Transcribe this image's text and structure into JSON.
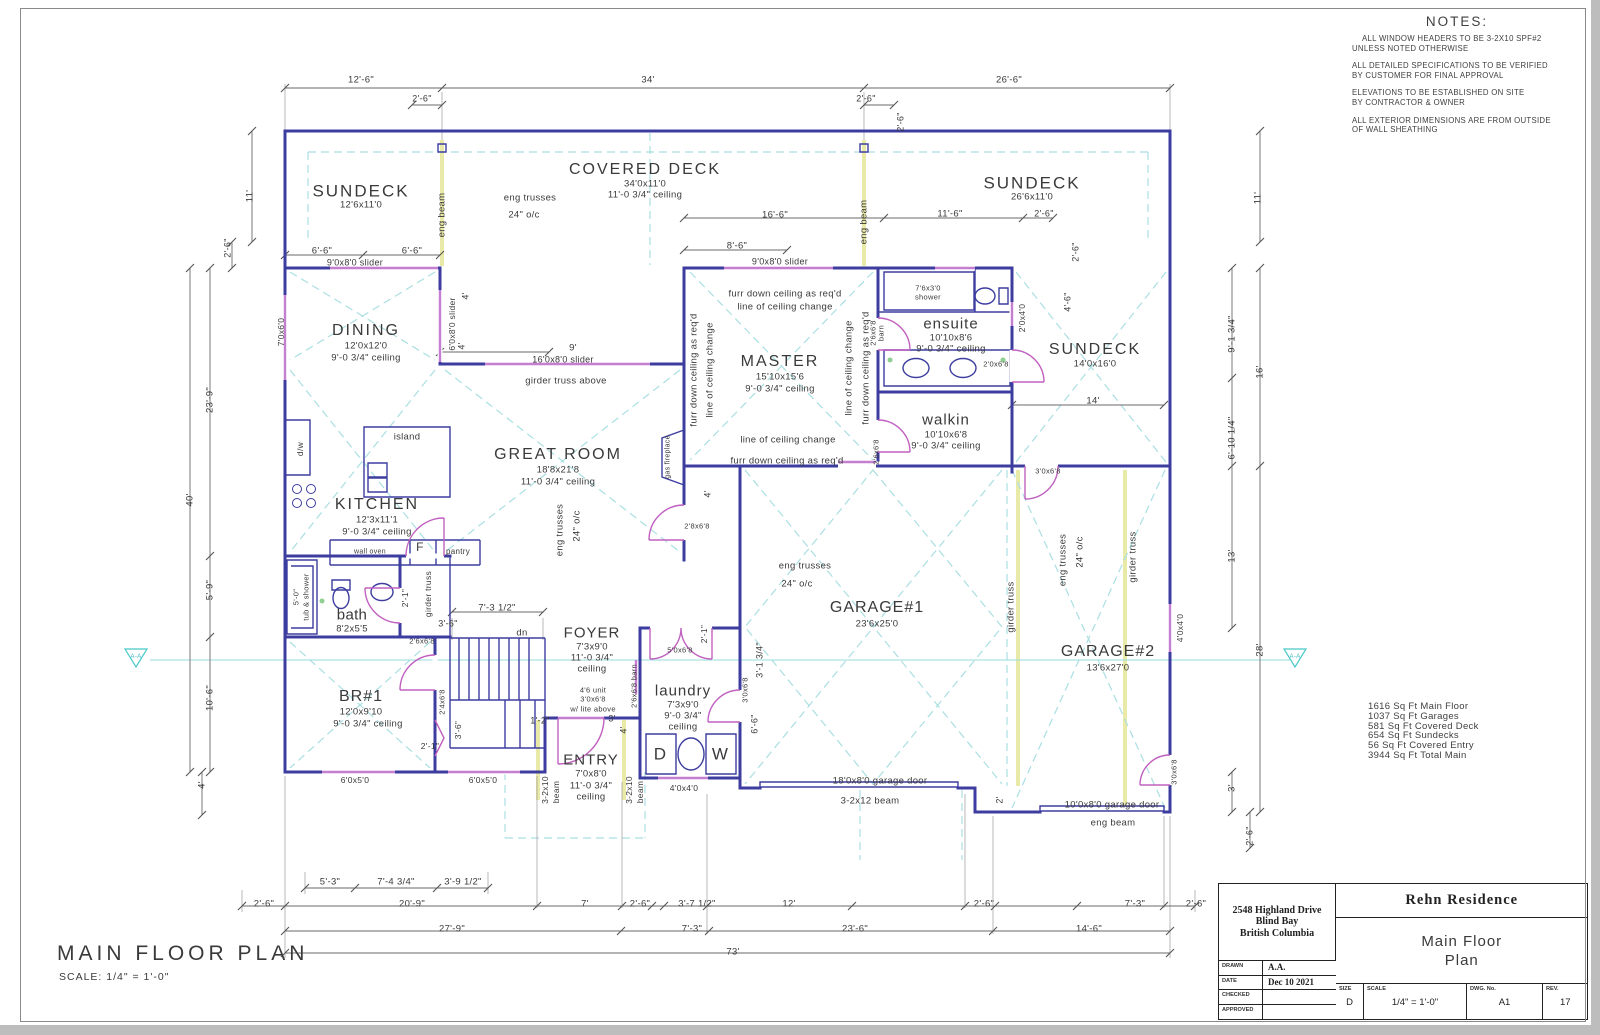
{
  "sheet": {
    "plan_title": "MAIN FLOOR PLAN",
    "plan_scale": "SCALE: 1/4\" = 1'-0\""
  },
  "notes": {
    "title": "NOTES:",
    "items": [
      "ALL WINDOW HEADERS TO BE 3-2X10 SPF#2\nUNLESS NOTED OTHERWISE",
      "ALL DETAILED SPECIFICATIONS TO BE VERIFIED\nBY CUSTOMER FOR FINAL APPROVAL",
      "ELEVATIONS TO BE ESTABLISHED ON SITE\nBY CONTRACTOR & OWNER",
      "ALL EXTERIOR DIMENSIONS ARE FROM OUTSIDE\nOF WALL SHEATHING"
    ]
  },
  "area_summary": [
    "1616 Sq Ft Main Floor",
    "1037 Sq Ft Garages",
    "581 Sq Ft Covered Deck",
    "654 Sq Ft Sundecks",
    "56 Sq Ft Covered Entry",
    "3944 Sq Ft Total Main"
  ],
  "title_block": {
    "address": [
      "2548 Highland Drive",
      "Blind Bay",
      "British Columbia"
    ],
    "project": "Rehn Residence",
    "drawing_title": [
      "Main Floor",
      "Plan"
    ],
    "fields": [
      {
        "label": "DRAWN",
        "value": "A.A."
      },
      {
        "label": "DATE",
        "value": "Dec 10 2021"
      },
      {
        "label": "CHECKED",
        "value": ""
      },
      {
        "label": "APPROVED",
        "value": ""
      }
    ],
    "size_label": "SIZE",
    "size": "D",
    "scale_label": "SCALE",
    "scale": "1/4\" = 1'-0\"",
    "dwg_label": "DWG. No.",
    "dwg": "A1",
    "rev_label": "REV.",
    "rev": "17"
  },
  "colors": {
    "wall": "#3d3da0",
    "window": "#c47fd0",
    "door_swing": "#c060c0",
    "truss_dashed": "#aadfe2",
    "beam_highlight": "#e9e9a8",
    "dimension": "#6a6a6a",
    "text": "#3a3a3a"
  },
  "plan": {
    "labels": [
      {
        "t": "12'-6\"",
        "x": 361,
        "y": 80
      },
      {
        "t": "2'-6\"",
        "x": 422,
        "y": 99,
        "fs": 9
      },
      {
        "t": "34'",
        "x": 648,
        "y": 80
      },
      {
        "t": "2'-6\"",
        "x": 866,
        "y": 99,
        "fs": 9
      },
      {
        "t": "26'-6\"",
        "x": 1009,
        "y": 80
      },
      {
        "t": "2'-6\"",
        "x": 901,
        "y": 122,
        "r": -90,
        "fs": 9
      },
      {
        "t": "SUNDECK",
        "x": 361,
        "y": 191,
        "fs": 17,
        "ls": 2
      },
      {
        "t": "12'6x11'0",
        "x": 361,
        "y": 205
      },
      {
        "t": "COVERED DECK",
        "x": 645,
        "y": 170,
        "fs": 16,
        "ls": 2
      },
      {
        "t": "34'0x11'0",
        "x": 645,
        "y": 184
      },
      {
        "t": "11'-0 3/4\" ceiling",
        "x": 645,
        "y": 195
      },
      {
        "t": "eng trusses",
        "x": 530,
        "y": 198
      },
      {
        "t": "24\" o/c",
        "x": 524,
        "y": 215
      },
      {
        "t": "eng beam",
        "x": 442,
        "y": 215,
        "r": -90,
        "fs": 9.5
      },
      {
        "t": "eng beam",
        "x": 864,
        "y": 222,
        "r": -90,
        "fs": 9.5
      },
      {
        "t": "SUNDECK",
        "x": 1032,
        "y": 183,
        "fs": 17,
        "ls": 2
      },
      {
        "t": "26'6x11'0",
        "x": 1032,
        "y": 197
      },
      {
        "t": "11'",
        "x": 250,
        "y": 196,
        "r": -90
      },
      {
        "t": "11'",
        "x": 1258,
        "y": 198,
        "r": -90
      },
      {
        "t": "16'-6\"",
        "x": 775,
        "y": 215
      },
      {
        "t": "11'-6\"",
        "x": 950,
        "y": 214
      },
      {
        "t": "2'-6\"",
        "x": 1044,
        "y": 214,
        "fs": 9
      },
      {
        "t": "8'-6\"",
        "x": 737,
        "y": 246
      },
      {
        "t": "2'-6\"",
        "x": 1076,
        "y": 252,
        "r": -90,
        "fs": 9
      },
      {
        "t": "4'-6\"",
        "x": 1068,
        "y": 302,
        "r": -90,
        "fs": 9
      },
      {
        "t": "6'-6\"",
        "x": 322,
        "y": 251,
        "fs": 9.5
      },
      {
        "t": "6'-6\"",
        "x": 412,
        "y": 251,
        "fs": 9.5
      },
      {
        "t": "9'0x8'0 slider",
        "x": 355,
        "y": 263,
        "fs": 9
      },
      {
        "t": "9'0x8'0 slider",
        "x": 780,
        "y": 262,
        "fs": 9
      },
      {
        "t": "2'-6\"",
        "x": 228,
        "y": 248,
        "r": -90,
        "fs": 9
      },
      {
        "t": "DINING",
        "x": 366,
        "y": 331,
        "fs": 16,
        "ls": 2
      },
      {
        "t": "12'0x12'0",
        "x": 366,
        "y": 346
      },
      {
        "t": "9'-0 3/4\" ceiling",
        "x": 366,
        "y": 358
      },
      {
        "t": "7'0x6'0",
        "x": 281,
        "y": 332,
        "r": -90,
        "fs": 8.5
      },
      {
        "t": "6'0x8'0 slider",
        "x": 452,
        "y": 324,
        "r": -90,
        "fs": 8.5
      },
      {
        "t": "4'",
        "x": 466,
        "y": 296,
        "r": -90,
        "fs": 9
      },
      {
        "t": "4'",
        "x": 462,
        "y": 346,
        "r": -90,
        "fs": 9
      },
      {
        "t": "9'",
        "x": 573,
        "y": 348,
        "fs": 9.5
      },
      {
        "t": "16'0x8'0 slider",
        "x": 563,
        "y": 360,
        "fs": 9
      },
      {
        "t": "girder truss above",
        "x": 566,
        "y": 381,
        "fs": 9.5
      },
      {
        "t": "island",
        "x": 407,
        "y": 437,
        "fs": 9.5
      },
      {
        "t": "KITCHEN",
        "x": 377,
        "y": 505,
        "fs": 16,
        "ls": 2
      },
      {
        "t": "12'3x11'1",
        "x": 377,
        "y": 520
      },
      {
        "t": "9'-0 3/4\" ceiling",
        "x": 377,
        "y": 532
      },
      {
        "t": "d/w",
        "x": 300,
        "y": 449,
        "r": -90,
        "fs": 8.5
      },
      {
        "t": "wall oven",
        "x": 370,
        "y": 552,
        "fs": 7
      },
      {
        "t": "pantry",
        "x": 458,
        "y": 552,
        "fs": 8
      },
      {
        "t": "F",
        "x": 420,
        "y": 547,
        "fs": 12
      },
      {
        "t": "girder truss",
        "x": 428,
        "y": 594,
        "r": -90,
        "fs": 8.5
      },
      {
        "t": "GREAT ROOM",
        "x": 558,
        "y": 455,
        "fs": 16,
        "ls": 2
      },
      {
        "t": "18'8x21'8",
        "x": 558,
        "y": 470
      },
      {
        "t": "11'-0 3/4\" ceiling",
        "x": 558,
        "y": 482
      },
      {
        "t": "eng trusses",
        "x": 560,
        "y": 530,
        "r": -90
      },
      {
        "t": "24\" o/c",
        "x": 577,
        "y": 526,
        "r": -90
      },
      {
        "t": "gas fireplace",
        "x": 668,
        "y": 457,
        "r": -90,
        "fs": 7
      },
      {
        "t": "furr down ceiling as req'd",
        "x": 785,
        "y": 294,
        "fs": 9.5
      },
      {
        "t": "line of ceiling change",
        "x": 785,
        "y": 307,
        "fs": 9.5
      },
      {
        "t": "MASTER",
        "x": 780,
        "y": 362,
        "fs": 16,
        "ls": 2
      },
      {
        "t": "15'10x15'6",
        "x": 780,
        "y": 377
      },
      {
        "t": "9'-0 3/4\" ceiling",
        "x": 780,
        "y": 389
      },
      {
        "t": "line of ceiling change",
        "x": 788,
        "y": 440,
        "fs": 9.5
      },
      {
        "t": "furr down ceiling as req'd",
        "x": 787,
        "y": 461,
        "fs": 9.5
      },
      {
        "t": "furr down ceiling as req'd",
        "x": 694,
        "y": 370,
        "r": -90,
        "fs": 9.5
      },
      {
        "t": "line of ceiling change",
        "x": 710,
        "y": 370,
        "r": -90,
        "fs": 9.5
      },
      {
        "t": "line of ceiling change",
        "x": 849,
        "y": 368,
        "r": -90,
        "fs": 9.5
      },
      {
        "t": "furr down ceiling as req'd",
        "x": 866,
        "y": 368,
        "r": -90,
        "fs": 9.5
      },
      {
        "t": "2'6x6'8",
        "x": 873,
        "y": 333,
        "r": -90,
        "fs": 7.5
      },
      {
        "t": "barn",
        "x": 881,
        "y": 333,
        "r": -90,
        "fs": 7.5
      },
      {
        "t": "2'6x6'8",
        "x": 876,
        "y": 452,
        "r": -90,
        "fs": 7.5
      },
      {
        "t": "2'8x6'8",
        "x": 697,
        "y": 526,
        "fs": 7.5
      },
      {
        "t": "4'",
        "x": 708,
        "y": 494,
        "r": -90,
        "fs": 9
      },
      {
        "t": "7'6x3'0",
        "x": 928,
        "y": 288,
        "fs": 7.5
      },
      {
        "t": "shower",
        "x": 928,
        "y": 297,
        "fs": 7.5
      },
      {
        "t": "ensuite",
        "x": 951,
        "y": 324,
        "fs": 15,
        "ls": 1
      },
      {
        "t": "10'10x8'6",
        "x": 951,
        "y": 338
      },
      {
        "t": "9'-0 3/4\" ceiling",
        "x": 951,
        "y": 349
      },
      {
        "t": "2'0x4'0",
        "x": 1022,
        "y": 318,
        "r": -90,
        "fs": 8.5
      },
      {
        "t": "2'0x6'8",
        "x": 996,
        "y": 364,
        "fs": 7.5
      },
      {
        "t": "walkin",
        "x": 946,
        "y": 420,
        "fs": 15,
        "ls": 1
      },
      {
        "t": "10'10x6'8",
        "x": 946,
        "y": 435
      },
      {
        "t": "9'-0 3/4\" ceiling",
        "x": 946,
        "y": 446
      },
      {
        "t": "SUNDECK",
        "x": 1095,
        "y": 350,
        "fs": 16,
        "ls": 2
      },
      {
        "t": "14'0x16'0",
        "x": 1095,
        "y": 364
      },
      {
        "t": "14'",
        "x": 1093,
        "y": 401
      },
      {
        "t": "3'0x6'8",
        "x": 1048,
        "y": 471,
        "fs": 7.5
      },
      {
        "t": "9'-1 3/4\"",
        "x": 1232,
        "y": 334,
        "r": -90
      },
      {
        "t": "16'",
        "x": 1260,
        "y": 372,
        "r": -90
      },
      {
        "t": "6'-10 1/4\"",
        "x": 1232,
        "y": 438,
        "r": -90
      },
      {
        "t": "13'",
        "x": 1232,
        "y": 556,
        "r": -90
      },
      {
        "t": "28'",
        "x": 1260,
        "y": 650,
        "r": -90
      },
      {
        "t": "4'0x4'0",
        "x": 1180,
        "y": 628,
        "r": -90,
        "fs": 8.5
      },
      {
        "t": "3'",
        "x": 1232,
        "y": 788,
        "r": -90
      },
      {
        "t": "3'0x6'8",
        "x": 1174,
        "y": 772,
        "r": -90,
        "fs": 7.5
      },
      {
        "t": "2'-6\"",
        "x": 1250,
        "y": 836,
        "r": -90,
        "fs": 9
      },
      {
        "t": "23'-9\"",
        "x": 210,
        "y": 400,
        "r": -90
      },
      {
        "t": "40'",
        "x": 190,
        "y": 500,
        "r": -90
      },
      {
        "t": "5'-9\"",
        "x": 210,
        "y": 590,
        "r": -90
      },
      {
        "t": "10'-6\"",
        "x": 210,
        "y": 698,
        "r": -90
      },
      {
        "t": "4'",
        "x": 202,
        "y": 785,
        "r": -90
      },
      {
        "t": "5'-0\"",
        "x": 296,
        "y": 597,
        "r": -90,
        "fs": 7.5
      },
      {
        "t": "tub & shower",
        "x": 306,
        "y": 597,
        "r": -90,
        "fs": 7.5
      },
      {
        "t": "bath",
        "x": 352,
        "y": 615,
        "fs": 15
      },
      {
        "t": "8'2x5'5",
        "x": 352,
        "y": 629
      },
      {
        "t": "2'-1\"",
        "x": 405,
        "y": 598,
        "r": -90,
        "fs": 8.5
      },
      {
        "t": "3'-6\"",
        "x": 448,
        "y": 624,
        "fs": 9
      },
      {
        "t": "2'6x6'8",
        "x": 422,
        "y": 641,
        "fs": 7.5
      },
      {
        "t": "7'-3 1/2\"",
        "x": 497,
        "y": 608
      },
      {
        "t": "dn",
        "x": 522,
        "y": 633,
        "fs": 9.5
      },
      {
        "t": "BR#1",
        "x": 361,
        "y": 697,
        "fs": 16,
        "ls": 1
      },
      {
        "t": "12'0x9'10",
        "x": 361,
        "y": 712
      },
      {
        "t": "9'-0 3/4\" ceiling",
        "x": 368,
        "y": 724
      },
      {
        "t": "2'4x6'8",
        "x": 442,
        "y": 702,
        "r": -90,
        "fs": 7.5
      },
      {
        "t": "2'-1\"",
        "x": 430,
        "y": 746,
        "fs": 8.5
      },
      {
        "t": "3'-6\"",
        "x": 458,
        "y": 730,
        "r": -90,
        "fs": 8.5
      },
      {
        "t": "6'0x5'0",
        "x": 355,
        "y": 780,
        "fs": 8.5
      },
      {
        "t": "6'0x5'0",
        "x": 483,
        "y": 780,
        "fs": 8.5
      },
      {
        "t": "FOYER",
        "x": 592,
        "y": 633,
        "fs": 15,
        "ls": 1
      },
      {
        "t": "7'3x9'0",
        "x": 592,
        "y": 647
      },
      {
        "t": "11'-0 3/4\"",
        "x": 592,
        "y": 658
      },
      {
        "t": "ceiling",
        "x": 592,
        "y": 669
      },
      {
        "t": "4'6 unit",
        "x": 593,
        "y": 690,
        "fs": 7.5
      },
      {
        "t": "3'0x6'8",
        "x": 593,
        "y": 699,
        "fs": 7.5
      },
      {
        "t": "w/ lite above",
        "x": 593,
        "y": 709,
        "fs": 7.5
      },
      {
        "t": "3'",
        "x": 612,
        "y": 719,
        "fs": 9
      },
      {
        "t": "4'",
        "x": 624,
        "y": 730,
        "r": -90,
        "fs": 9
      },
      {
        "t": "1'-2\"",
        "x": 540,
        "y": 721,
        "fs": 9
      },
      {
        "t": "ENTRY",
        "x": 591,
        "y": 760,
        "fs": 15,
        "ls": 1
      },
      {
        "t": "7'0x8'0",
        "x": 591,
        "y": 774
      },
      {
        "t": "11'-0 3/4\"",
        "x": 591,
        "y": 786
      },
      {
        "t": "ceiling",
        "x": 591,
        "y": 797
      },
      {
        "t": "3-2x10",
        "x": 545,
        "y": 790,
        "r": -90,
        "fs": 8.5
      },
      {
        "t": "beam",
        "x": 556,
        "y": 792,
        "r": -90,
        "fs": 8.5
      },
      {
        "t": "3-2x10",
        "x": 629,
        "y": 790,
        "r": -90,
        "fs": 8.5
      },
      {
        "t": "beam",
        "x": 640,
        "y": 792,
        "r": -90,
        "fs": 8.5
      },
      {
        "t": "laundry",
        "x": 683,
        "y": 691,
        "fs": 15,
        "ls": 1
      },
      {
        "t": "7'3x9'0",
        "x": 683,
        "y": 705
      },
      {
        "t": "9'-0 3/4\"",
        "x": 683,
        "y": 716
      },
      {
        "t": "ceiling",
        "x": 683,
        "y": 727
      },
      {
        "t": "5'0x6'8",
        "x": 680,
        "y": 650,
        "fs": 7.5
      },
      {
        "t": "2'-1\"",
        "x": 704,
        "y": 634,
        "r": -90,
        "fs": 8.5
      },
      {
        "t": "2'6x6'8 barn",
        "x": 634,
        "y": 686,
        "r": -90,
        "fs": 7.5
      },
      {
        "t": "3'0x6'8",
        "x": 745,
        "y": 690,
        "r": -90,
        "fs": 7.5
      },
      {
        "t": "3'-1 3/4\"",
        "x": 760,
        "y": 660,
        "r": -90,
        "fs": 9
      },
      {
        "t": "6'-6\"",
        "x": 755,
        "y": 724,
        "r": -90,
        "fs": 9
      },
      {
        "t": "D",
        "x": 660,
        "y": 754,
        "fs": 17
      },
      {
        "t": "W",
        "x": 720,
        "y": 754,
        "fs": 17
      },
      {
        "t": "4'0x4'0",
        "x": 684,
        "y": 788,
        "fs": 8.5
      },
      {
        "t": "eng trusses",
        "x": 805,
        "y": 566
      },
      {
        "t": "24\" o/c",
        "x": 797,
        "y": 584
      },
      {
        "t": "GARAGE#1",
        "x": 877,
        "y": 608,
        "fs": 16,
        "ls": 1
      },
      {
        "t": "23'6x25'0",
        "x": 877,
        "y": 624
      },
      {
        "t": "girder truss",
        "x": 1011,
        "y": 607,
        "r": -90
      },
      {
        "t": "eng trusses",
        "x": 1063,
        "y": 560,
        "r": -90
      },
      {
        "t": "24\" o/c",
        "x": 1080,
        "y": 552,
        "r": -90
      },
      {
        "t": "girder truss",
        "x": 1133,
        "y": 557,
        "r": -90
      },
      {
        "t": "GARAGE#2",
        "x": 1108,
        "y": 652,
        "fs": 16,
        "ls": 1
      },
      {
        "t": "13'6x27'0",
        "x": 1108,
        "y": 668
      },
      {
        "t": "2'",
        "x": 1000,
        "y": 800,
        "r": -90,
        "fs": 9
      },
      {
        "t": "18'0x8'0 garage door",
        "x": 880,
        "y": 781,
        "fs": 9.5
      },
      {
        "t": "3-2x12 beam",
        "x": 870,
        "y": 801,
        "fs": 9.5
      },
      {
        "t": "10'0x8'0 garage door",
        "x": 1112,
        "y": 805,
        "fs": 9.5
      },
      {
        "t": "eng beam",
        "x": 1113,
        "y": 823,
        "fs": 9.5
      },
      {
        "t": "A-A",
        "x": 136,
        "y": 657,
        "fs": 6,
        "c": "#3db8bc"
      },
      {
        "t": "A-A",
        "x": 1295,
        "y": 657,
        "fs": 6,
        "c": "#3db8bc"
      },
      {
        "t": "5'-3\"",
        "x": 330,
        "y": 882,
        "fs": 9.5
      },
      {
        "t": "7'-4 3/4\"",
        "x": 396,
        "y": 882,
        "fs": 9.5
      },
      {
        "t": "3'-9 1/2\"",
        "x": 463,
        "y": 882,
        "fs": 9.5
      },
      {
        "t": "2'-6\"",
        "x": 264,
        "y": 904,
        "fs": 9.5
      },
      {
        "t": "20'-9\"",
        "x": 412,
        "y": 904
      },
      {
        "t": "7'",
        "x": 585,
        "y": 904
      },
      {
        "t": "2'-6\"",
        "x": 640,
        "y": 904,
        "fs": 9.5
      },
      {
        "t": "3'-7 1/2\"",
        "x": 697,
        "y": 904,
        "fs": 9.5
      },
      {
        "t": "12'",
        "x": 789,
        "y": 904
      },
      {
        "t": "2'-6\"",
        "x": 984,
        "y": 904,
        "fs": 9.5
      },
      {
        "t": "7'-3\"",
        "x": 1135,
        "y": 904,
        "fs": 9.5
      },
      {
        "t": "2'-6\"",
        "x": 1196,
        "y": 904,
        "fs": 9.5
      },
      {
        "t": "27'-9\"",
        "x": 452,
        "y": 929
      },
      {
        "t": "7'-3\"",
        "x": 692,
        "y": 929
      },
      {
        "t": "23'-6\"",
        "x": 855,
        "y": 929
      },
      {
        "t": "14'-6\"",
        "x": 1089,
        "y": 929
      },
      {
        "t": "73'",
        "x": 733,
        "y": 952
      }
    ]
  }
}
